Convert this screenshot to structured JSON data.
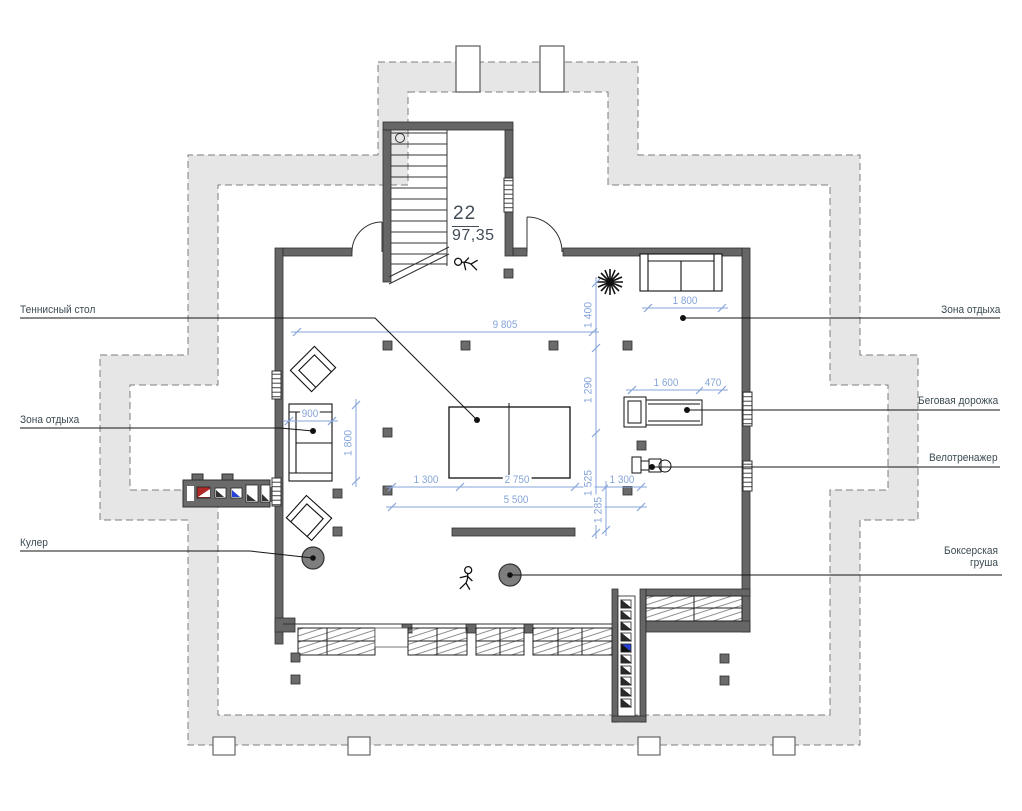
{
  "room": {
    "number": "22",
    "area": "97,35"
  },
  "callouts": {
    "tennis_table": "Теннисный стол",
    "rest_zone_left": "Зона отдыха",
    "cooler": "Кулер",
    "rest_zone_right": "Зона отдыха",
    "treadmill": "Беговая дорожка",
    "exercise_bike": "Велотренажер",
    "punching_bag": "Боксерская груша"
  },
  "dimensions": {
    "width_total": "9 805",
    "sofa_top_width": "1 800",
    "v1400": "1 400",
    "v1290": "1 290",
    "v1525": "1 525",
    "v1285": "1 285",
    "treadmill_length": "1 600",
    "treadmill_gap": "470",
    "sofa_left_width": "900",
    "sofa_left_height": "1 800",
    "bottom_1300_left": "1 300",
    "bottom_2750": "2 750",
    "bottom_1300_right": "1 300",
    "bottom_total": "5 500"
  },
  "colors": {
    "dimension": "#86a5da",
    "label": "#3b4a52",
    "wall": "#666666",
    "insulation_band": "#e6e6e6",
    "accent_red": "#b02828",
    "accent_blue": "#2742d8"
  }
}
